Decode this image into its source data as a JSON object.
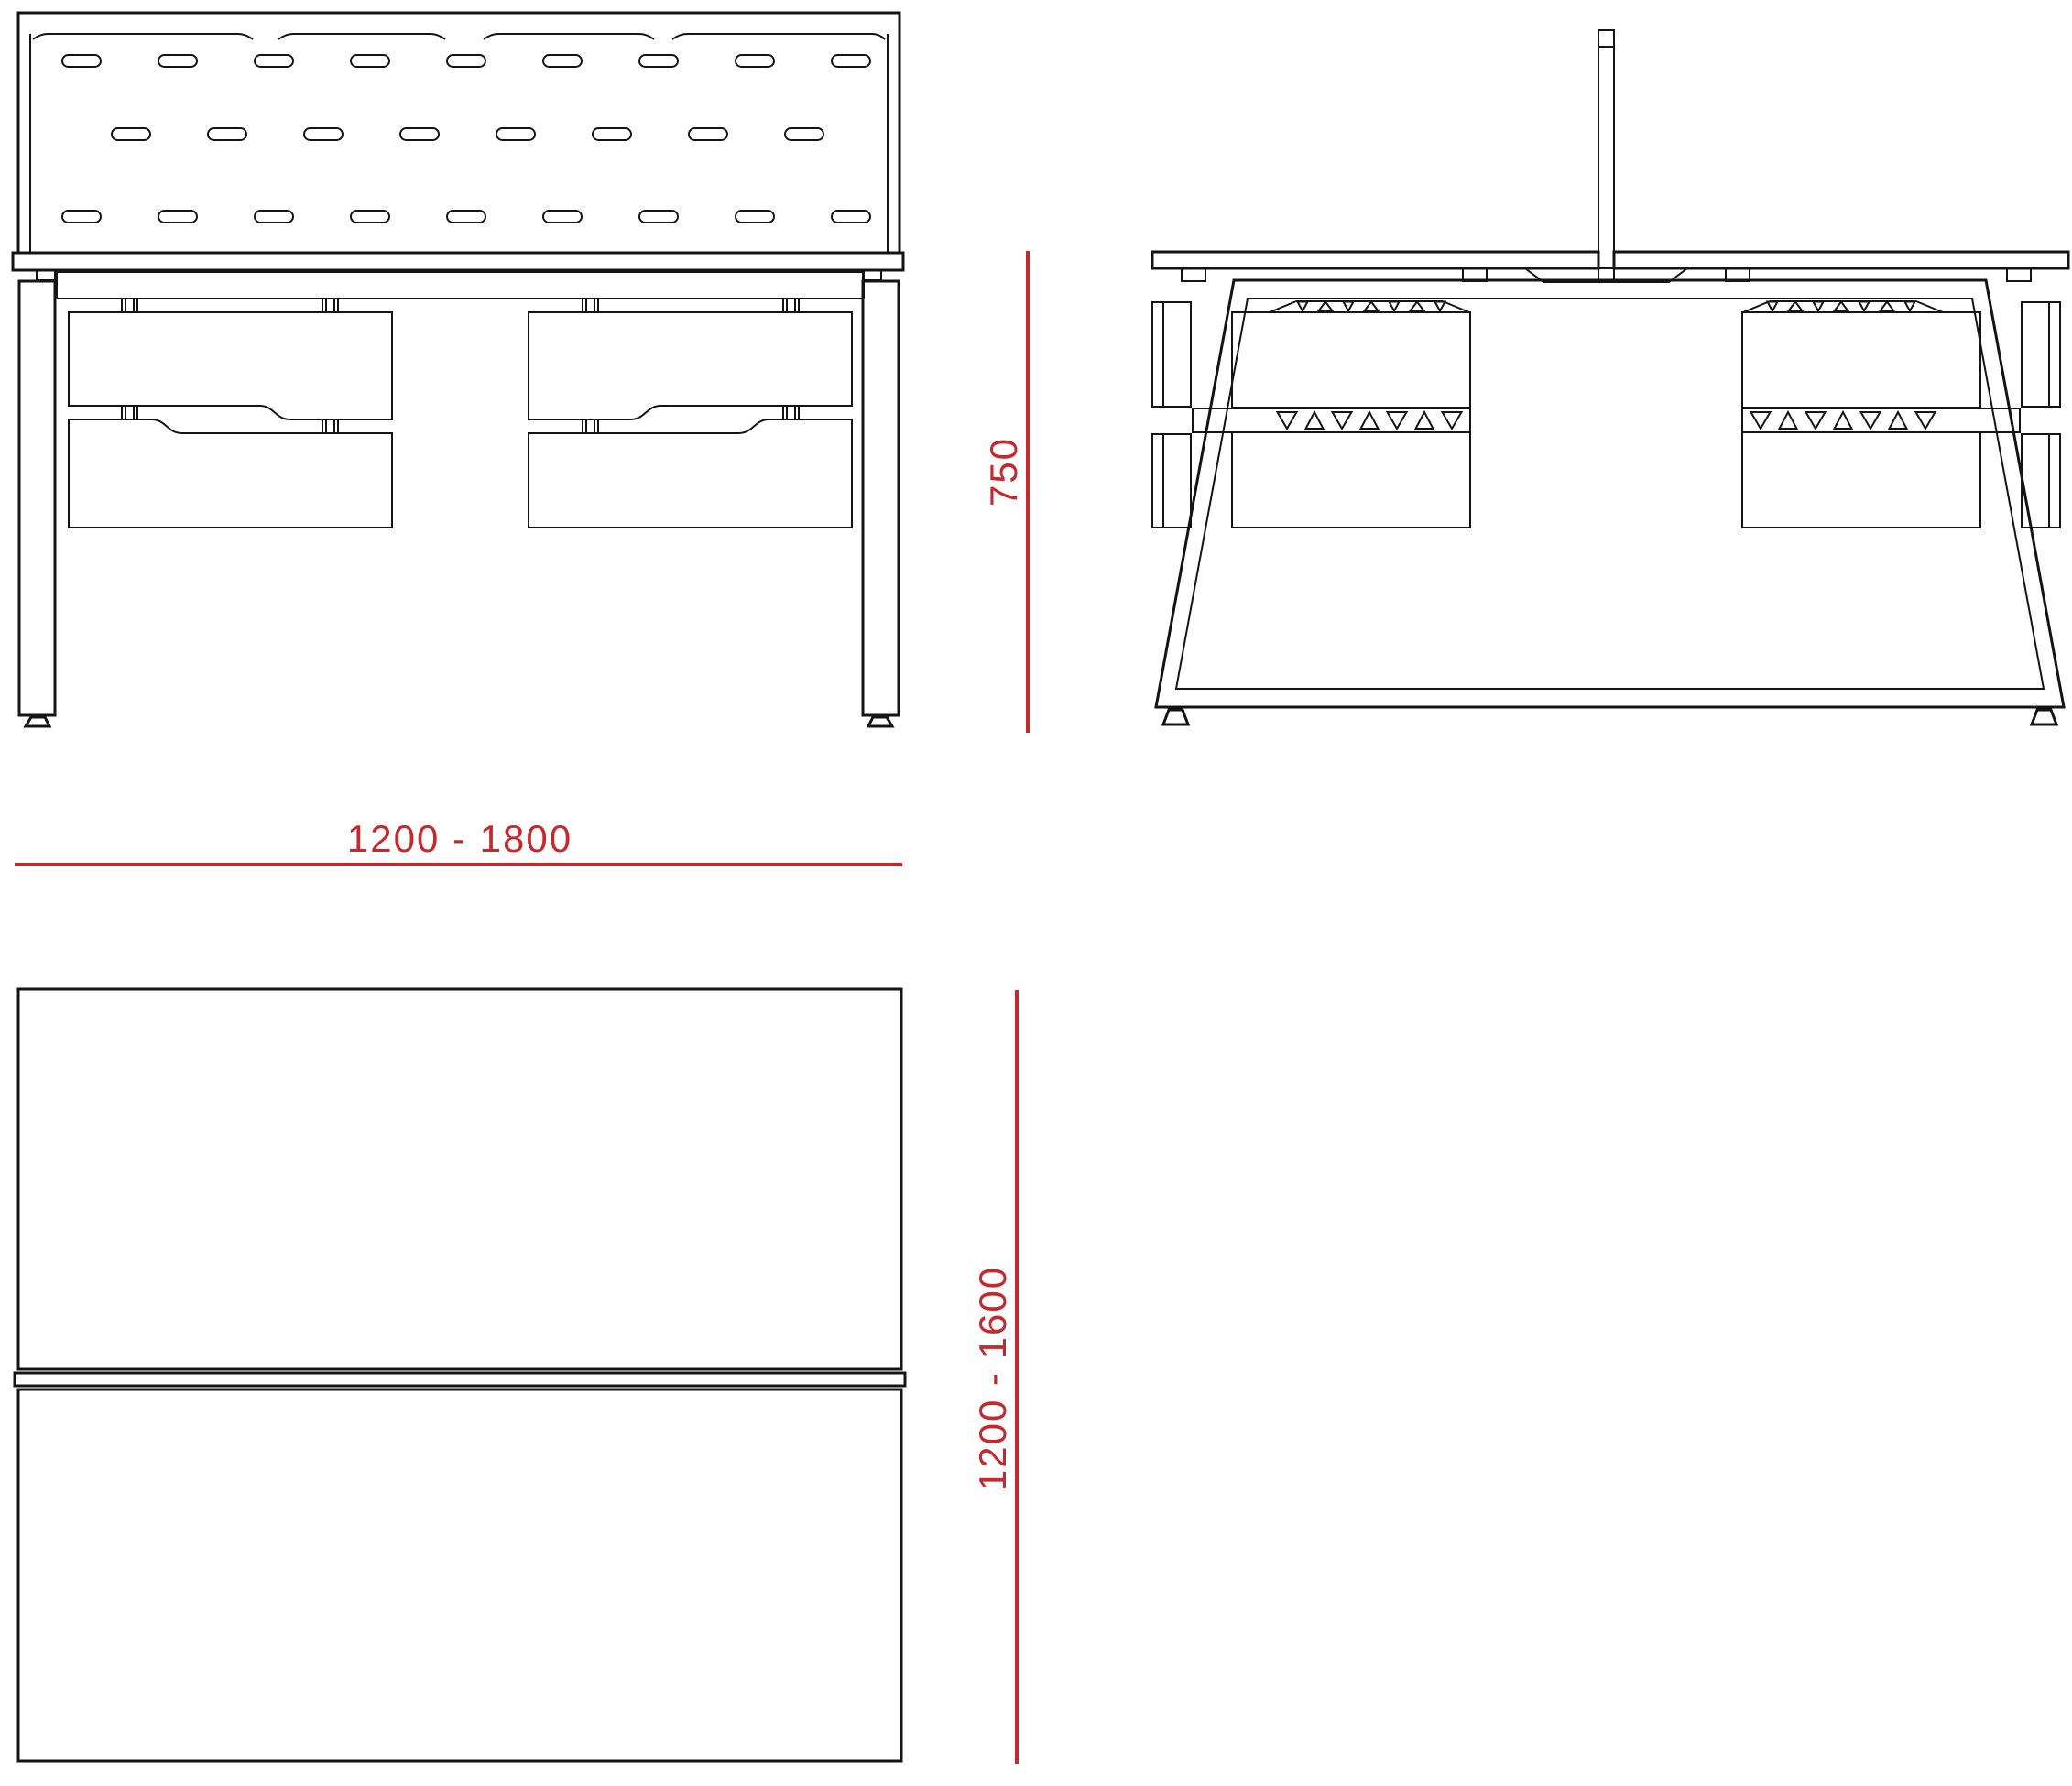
{
  "drawing": {
    "views": {
      "front_view": "front elevation with acoustic screen and suspended drawer units",
      "side_view": "side elevation with A-frame leg, centre divider screen and drawer pedestals",
      "plan_view": "top plan of double desktop with centre screen"
    },
    "dimensions": {
      "width_label": "1200 - 1800",
      "height_label": "750",
      "depth_label": "1200 - 1600"
    },
    "colors": {
      "dimension": "#c5282d",
      "line": "#141414",
      "background": "#ffffff"
    }
  }
}
